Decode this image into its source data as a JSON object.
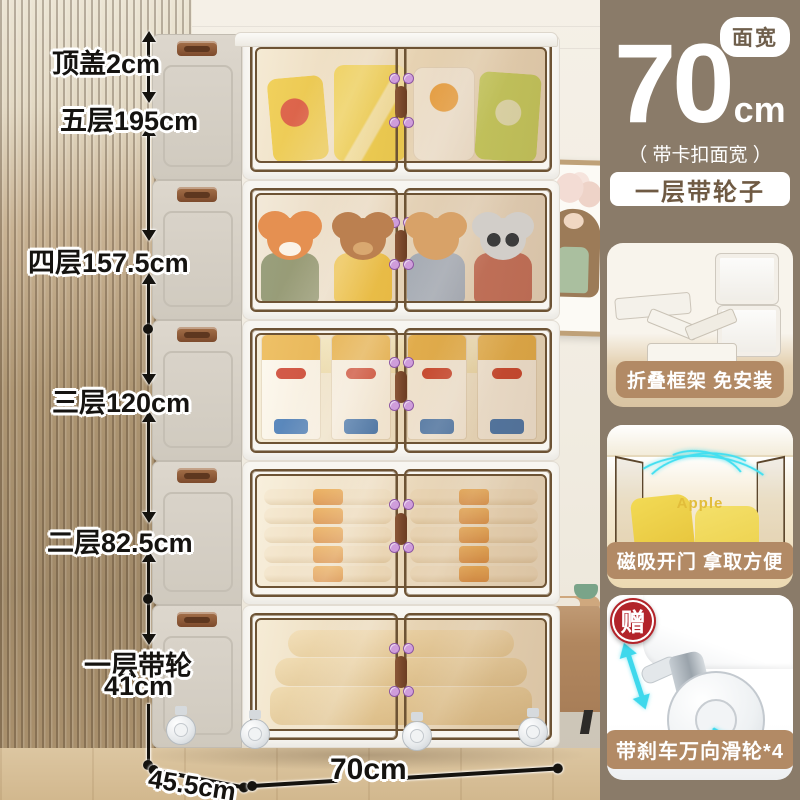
{
  "colors": {
    "panel_bg": "#8a7b69",
    "badge_tan": "#b28a65",
    "gift_red": "#b2242a",
    "accent_cyan": "#3ed8ec",
    "dim_label": "#151310",
    "pill_text": "#6f5a43"
  },
  "dims": {
    "top_lid": "顶盖2cm",
    "tier5": "五层195cm",
    "tier4": "四层157.5cm",
    "tier3": "三层120cm",
    "tier2": "二层82.5cm",
    "tier1_line1": "一层带轮",
    "tier1_line2": "41cm",
    "depth": "45.5cm",
    "width": "70cm"
  },
  "panel": {
    "bubble_label": "面宽",
    "big_value": "70",
    "unit": "cm",
    "subnote": "（ 带卡扣面宽 ）",
    "feature_pill": "一层带轮子",
    "card1_badge": "折叠框架 免安装",
    "card2_badge": "磁吸开门 拿取方便",
    "card2_brand": "Apple",
    "card3_gift": "赠",
    "card3_badge": "带刹车万向滑轮*4"
  },
  "icons": {
    "speech_bubble": "speech-bubble",
    "dimension_line": "double-arrow-measure-line",
    "gift_badge": "gift-circle-badge",
    "caster_wheel": "caster-wheel",
    "motion_arrows": "cyan-rotation-arrows"
  }
}
